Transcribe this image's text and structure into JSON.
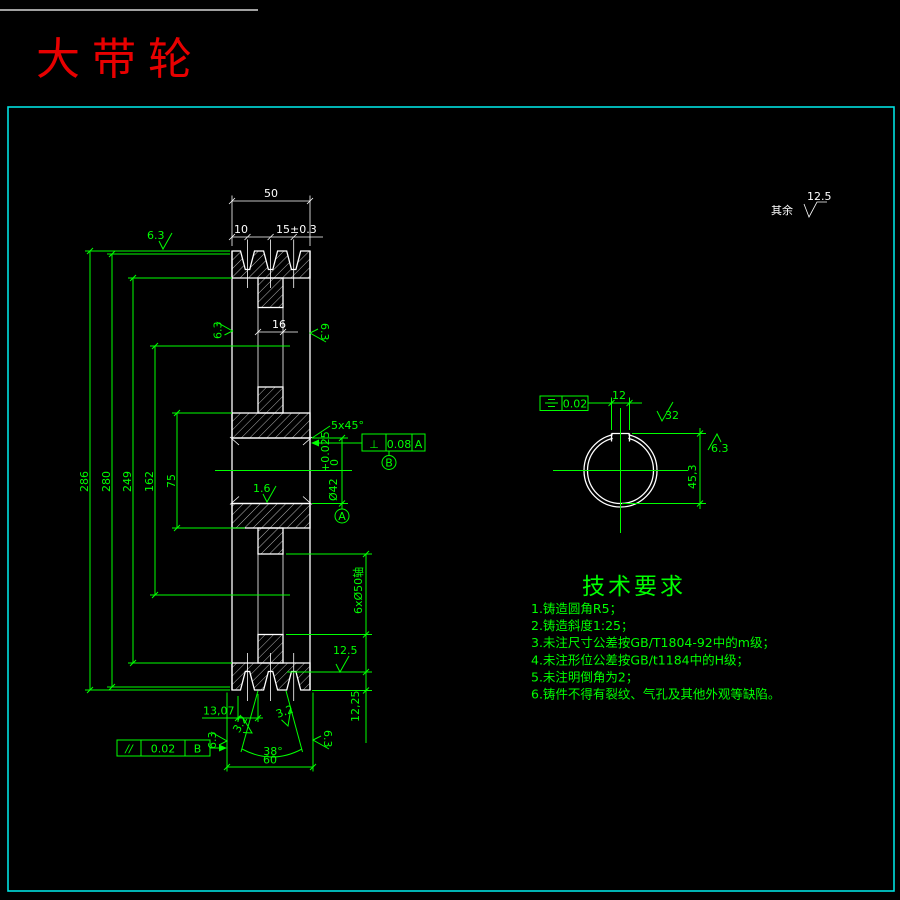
{
  "title": "大带轮",
  "general_roughness": {
    "label": "其余",
    "value": "12.5"
  },
  "dims": {
    "width": "50",
    "groove_offset": "10",
    "groove_pitch": "15±0.3",
    "dia_outer": "286",
    "dia_pitch": "280",
    "dia_rim_inner": "249",
    "dia_hole_circle": "162",
    "dia_hub": "75",
    "web_thickness": "16",
    "bore": "Ø42",
    "bore_tol_up": "+0.025",
    "bore_tol_low": "0",
    "chamfer": "5x45°",
    "holes": "6xØ50轴",
    "groove_loc": "13,07",
    "groove_angle": "38°",
    "bottom_width": "60",
    "groove_depth": "12,25",
    "keyway_width": "12",
    "keyway_depth": "45,3"
  },
  "frames": {
    "perpendicularity": {
      "symbol": "⊥",
      "value": "0.08",
      "datum": "A"
    },
    "parallelism": {
      "symbol": "//",
      "value": "0.02",
      "datum": "B"
    },
    "symmetry": {
      "value": "0.02"
    },
    "datum_a": "A",
    "datum_b": "B"
  },
  "roughness": {
    "outer": "6.3",
    "flank": "3.2",
    "groove_face": "12.5",
    "bore": "1.6",
    "keyway": "32"
  },
  "tech_req": {
    "title": "技术要求",
    "items": [
      "1.铸造圆角R5；",
      "2.铸造斜度1:25；",
      "3.未注尺寸公差按GB/T1804-92中的m级；",
      "4.未注形位公差按GB/t1184中的H级；",
      "5.未注明倒角为2；",
      "6.铸件不得有裂纹、气孔及其他外观等缺陷。"
    ]
  }
}
